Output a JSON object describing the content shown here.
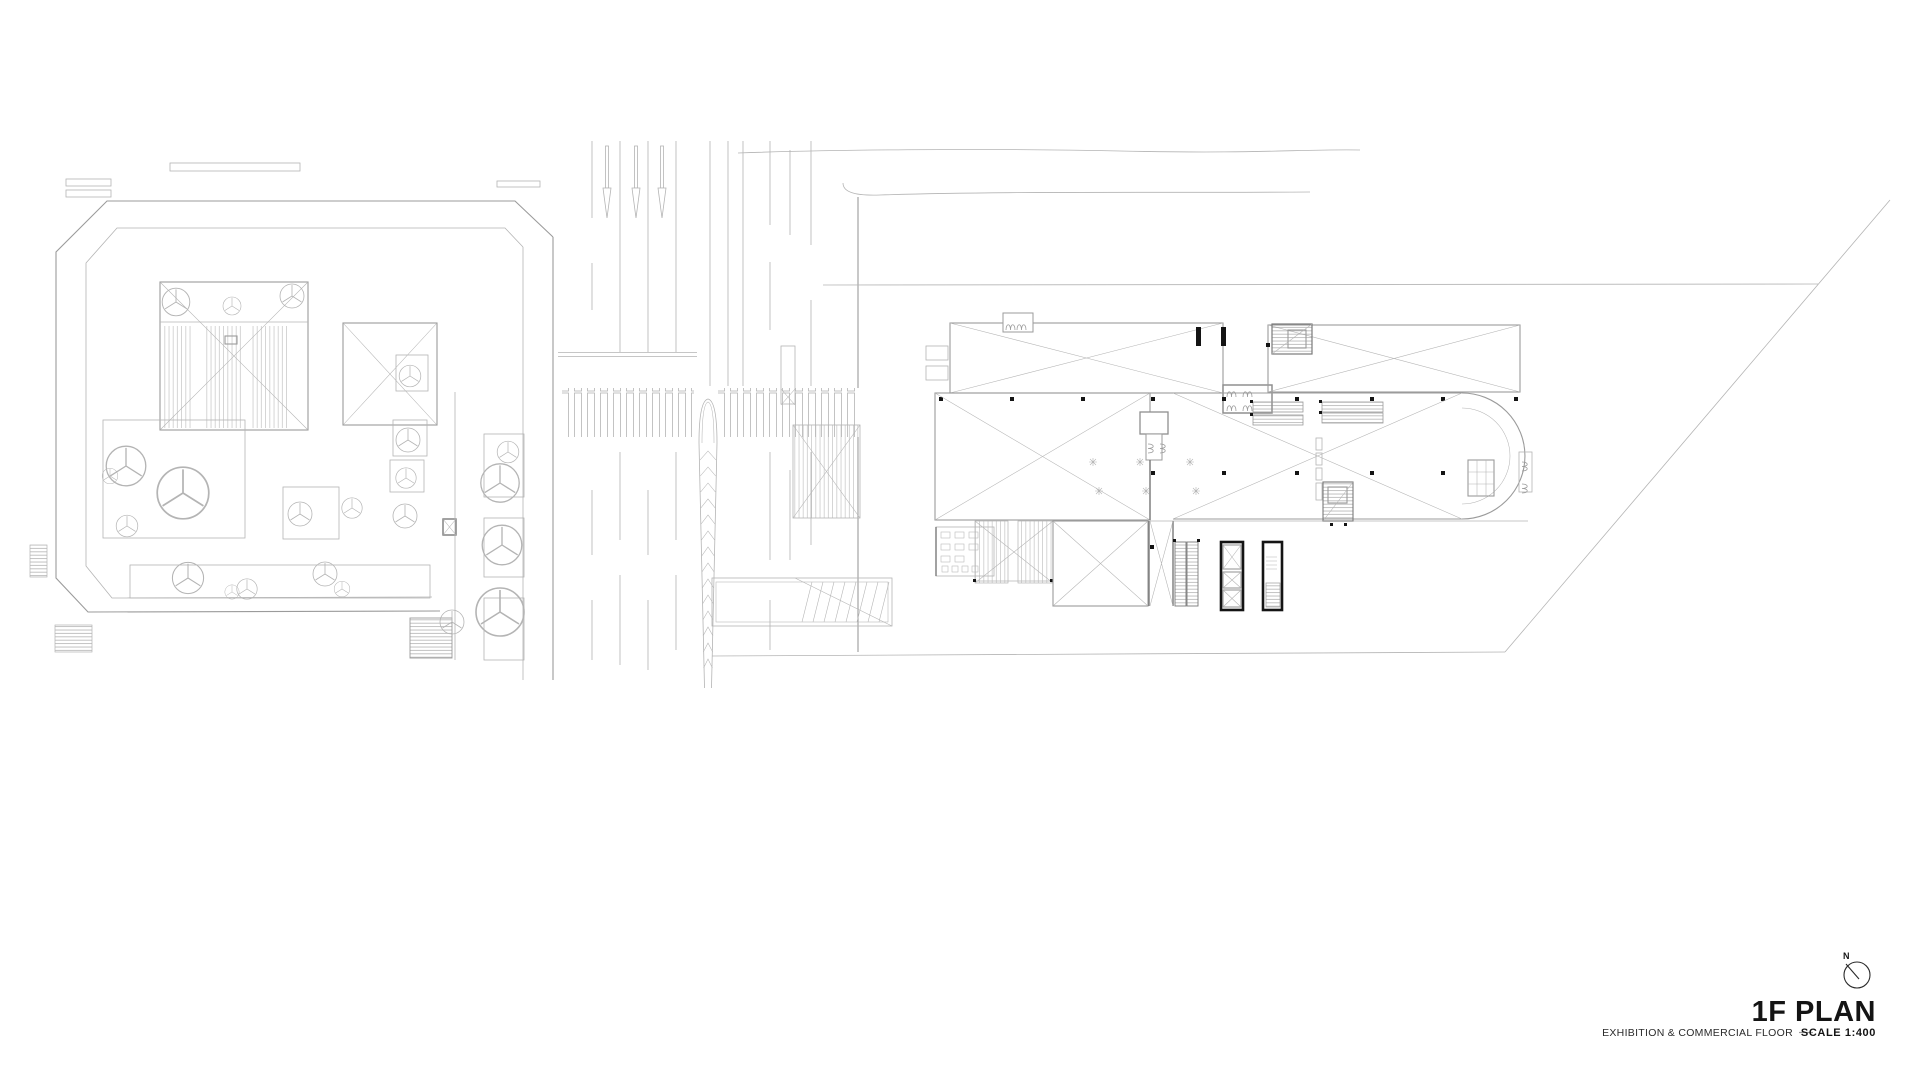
{
  "title_block": {
    "north_indicator": "N",
    "title": "1F PLAN",
    "floor_description": "EXHIBITION & COMMERCIAL FLOOR",
    "scale_label": "SCALE 1:400"
  },
  "icons": {
    "north_arrow": "circle-with-needle-compass"
  },
  "colors": {
    "background": "#ffffff",
    "line_light": "#b4b4b4",
    "line_medium": "#9b9b9b",
    "line_dark": "#7a7a7a",
    "accent_black": "#141414"
  }
}
